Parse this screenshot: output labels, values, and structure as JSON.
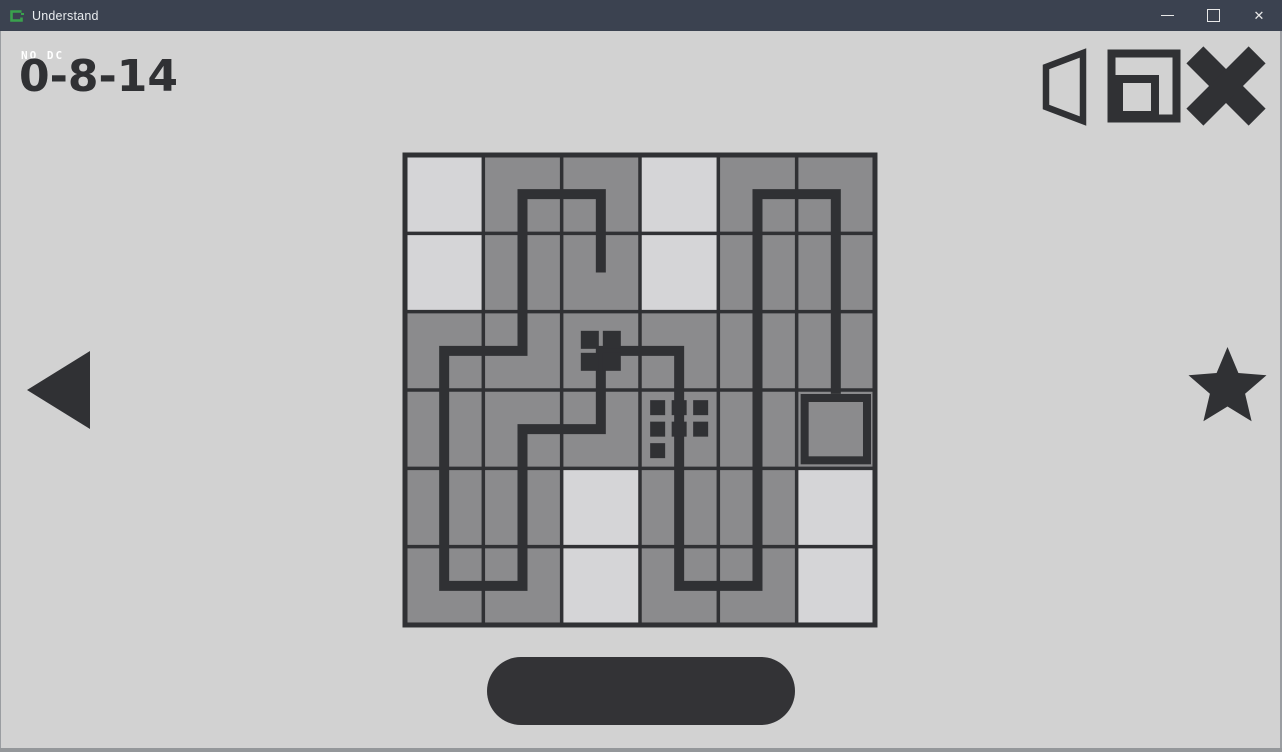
{
  "window": {
    "title": "Understand",
    "controls": [
      {
        "name": "minimize",
        "glyph": "—"
      },
      {
        "name": "maximize",
        "glyph": "□"
      },
      {
        "name": "close",
        "glyph": "✕"
      }
    ]
  },
  "hud": {
    "corner_label": "NO DC",
    "level_code": "0-8-14"
  },
  "toolbar_icons": [
    {
      "name": "speaker-icon"
    },
    {
      "name": "restart-icon"
    },
    {
      "name": "x-cross-icon"
    }
  ],
  "nav": {
    "prev": "left-triangle-icon",
    "next_indicator": "star-icon"
  },
  "footer": {
    "pill_label": ""
  },
  "colors": {
    "titlebar_bg": "#3b4250",
    "titlebar_text": "#e9ecef",
    "app_icon_green": "#3aa24d",
    "background": "#d2d2d2",
    "cell_gray": "#8b8b8d",
    "cell_light": "#d5d5d7",
    "ink": "#303134",
    "window_border": "#94979a"
  },
  "puzzle": {
    "grid": {
      "cols": 6,
      "rows": 6,
      "x": 405,
      "y": 155,
      "cell": 78.33,
      "line_width": 3.5,
      "border_width": 5,
      "path_width": 10
    },
    "light_cells": [
      [
        0,
        0
      ],
      [
        0,
        1
      ],
      [
        3,
        0
      ],
      [
        3,
        1
      ],
      [
        2,
        4
      ],
      [
        2,
        5
      ],
      [
        5,
        4
      ],
      [
        5,
        5
      ]
    ],
    "path_points": [
      [
        2,
        1
      ],
      [
        2,
        0
      ],
      [
        1,
        0
      ],
      [
        1,
        2
      ],
      [
        0,
        2
      ],
      [
        0,
        5
      ],
      [
        1,
        5
      ],
      [
        1,
        3
      ],
      [
        2,
        3
      ],
      [
        2,
        2
      ],
      [
        3,
        2
      ],
      [
        3,
        5
      ],
      [
        4,
        5
      ],
      [
        4,
        0
      ],
      [
        5,
        0
      ],
      [
        5,
        2.55
      ]
    ],
    "dot_groups": [
      {
        "cell": [
          2,
          2
        ],
        "size": 18,
        "pitch": 22,
        "dots": [
          [
            -0.5,
            -0.5
          ],
          [
            0.5,
            -0.5
          ],
          [
            -0.5,
            0.5
          ],
          [
            0.5,
            0.5
          ]
        ]
      },
      {
        "cell": [
          3,
          3
        ],
        "size": 15,
        "pitch": 21.5,
        "dots": [
          [
            -1,
            -1
          ],
          [
            0,
            -1
          ],
          [
            1,
            -1
          ],
          [
            -1,
            0
          ],
          [
            0,
            0
          ],
          [
            1,
            0
          ],
          [
            -1,
            1
          ]
        ]
      }
    ],
    "box_cell": {
      "cell": [
        5,
        3
      ],
      "margin": 4,
      "stroke": 8
    }
  }
}
